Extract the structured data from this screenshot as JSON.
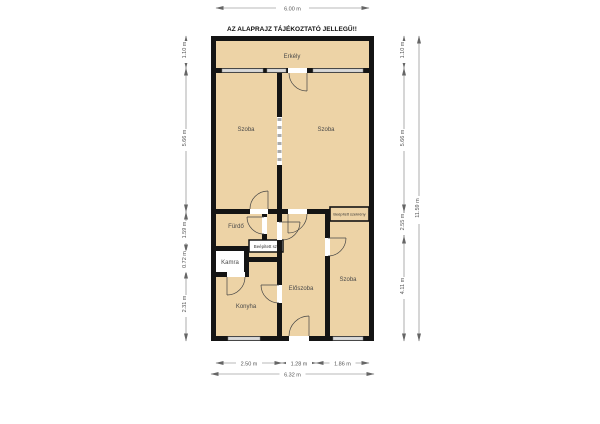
{
  "title": "AZ ALAPRAJZ TÁJÉKOZTATÓ JELLEGŰ!!",
  "floorplan": {
    "rooms": {
      "erkely": {
        "label": "Erkély"
      },
      "szoba_top_left": {
        "label": "Szoba"
      },
      "szoba_top_right": {
        "label": "Szoba"
      },
      "furdo": {
        "label": "Fürdő"
      },
      "beepitett_sz": {
        "label": "Beépített sz."
      },
      "kamra": {
        "label": "Kamra"
      },
      "konyha": {
        "label": "Konyha"
      },
      "eloszoba": {
        "label": "Előszoba"
      },
      "szoba_bottom_right": {
        "label": "Szoba"
      },
      "beepitett_szekreny": {
        "label": "Beépített szekrény"
      }
    },
    "dimensions": {
      "top_width": "6.00 m",
      "left": [
        "1.10 m",
        "5.66 m",
        "1.59 m",
        "0.72 m",
        "2.31 m"
      ],
      "right": [
        "1.10 m",
        "5.66 m",
        "2.55 m",
        "4.11 m"
      ],
      "right_total": "11.59 m",
      "bottom": [
        "2.50 m",
        "1.28 m",
        "1.86 m"
      ],
      "bottom_total": "6.32 m"
    },
    "colors": {
      "room_fill": "#EDD3A6",
      "wall": "#141414",
      "window": "#D9D9D9",
      "dimension_line": "#777777",
      "kamra_fill": "#FFFFFF"
    }
  }
}
